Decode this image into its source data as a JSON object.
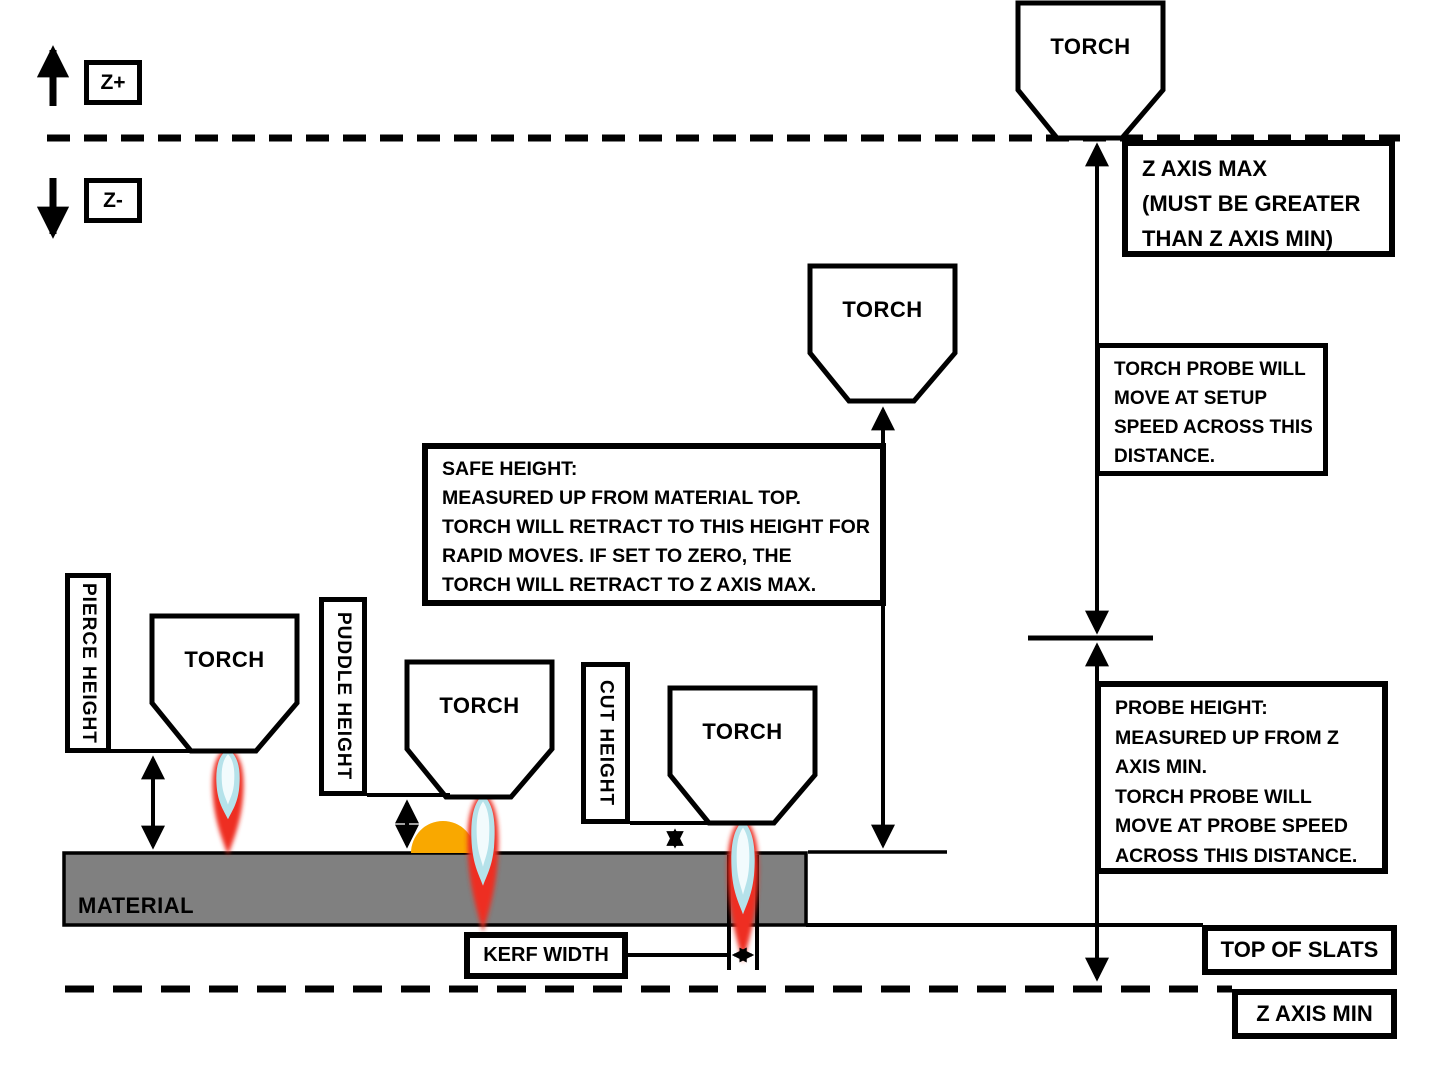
{
  "axis_arrows": {
    "z_plus": "Z+",
    "z_minus": "Z-"
  },
  "torch_label": "TORCH",
  "boxes": {
    "z_axis_max": "Z AXIS MAX\n(MUST BE GREATER\nTHAN Z AXIS MIN)",
    "torch_probe": "TORCH PROBE WILL\nMOVE AT SETUP\nSPEED ACROSS THIS\nDISTANCE.",
    "safe_height": "SAFE HEIGHT:\nMEASURED UP FROM MATERIAL TOP.\nTORCH WILL RETRACT TO THIS HEIGHT FOR\nRAPID MOVES.  IF SET TO ZERO, THE\nTORCH WILL RETRACT TO Z AXIS MAX.",
    "probe_height": "PROBE HEIGHT:\nMEASURED UP FROM Z\nAXIS MIN.\nTORCH PROBE WILL\nMOVE AT PROBE SPEED\nACROSS THIS DISTANCE.",
    "pierce_height": "PIERCE HEIGHT",
    "puddle_height": "PUDDLE HEIGHT",
    "cut_height": "CUT HEIGHT",
    "kerf_width": "KERF WIDTH",
    "material": "MATERIAL",
    "top_of_slats": "TOP OF SLATS",
    "z_axis_min": "Z AXIS MIN"
  },
  "colors": {
    "line": "#000000",
    "material_gray": "#808080",
    "puddle_orange": "#F9A800",
    "flame_red": "#EE2E24",
    "flame_blue": "#B5E2EA",
    "flame_core": "#F2FBFD"
  }
}
